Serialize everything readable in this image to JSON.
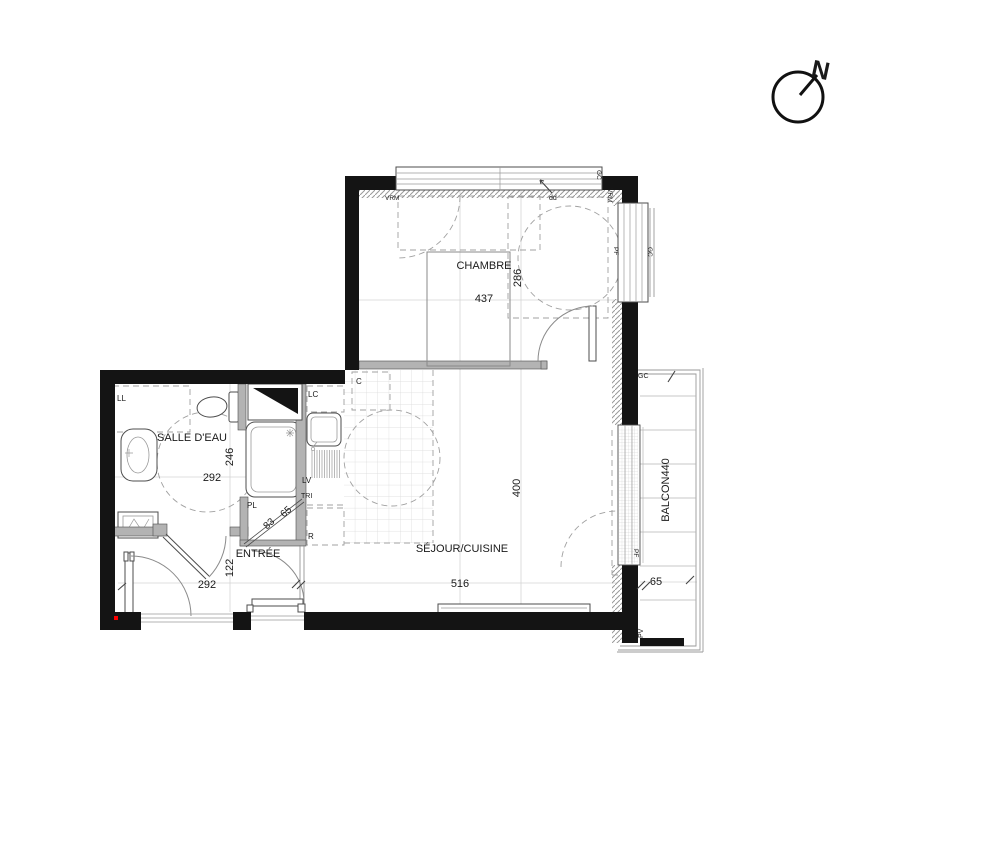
{
  "compass": {
    "north": "N"
  },
  "rooms": {
    "chambre": {
      "name": "CHAMBRE",
      "width_cm": "437",
      "depth_cm": "286"
    },
    "salle_deau": {
      "name": "SALLE D'EAU",
      "width_cm": "292",
      "depth_cm": "246"
    },
    "entree": {
      "name": "ENTRÉE",
      "width_cm": "292",
      "depth_cm": "122"
    },
    "sejour_cuisine": {
      "name": "SÉJOUR/CUISINE",
      "width_cm": "516",
      "depth_cm": "400"
    },
    "balcon": {
      "label": "BALCON440",
      "depth_cm": "65"
    }
  },
  "closet": {
    "label": "PL",
    "diag_dim_a": "83",
    "diag_dim_b": "65"
  },
  "kitchen": {
    "lc": "LC",
    "cooktop": "C",
    "dishwasher": "LV",
    "tri": "TRI",
    "fridge": "R"
  },
  "bathroom": {
    "washer": "LL"
  },
  "openings": {
    "shutter": "VRM",
    "door_note": "dd",
    "guardrail": "GC",
    "french_window": "PF",
    "pv": "PV"
  },
  "colors": {
    "wall": "#141414",
    "partition": "#b3b3b3",
    "red_marker": "#ff0000"
  }
}
